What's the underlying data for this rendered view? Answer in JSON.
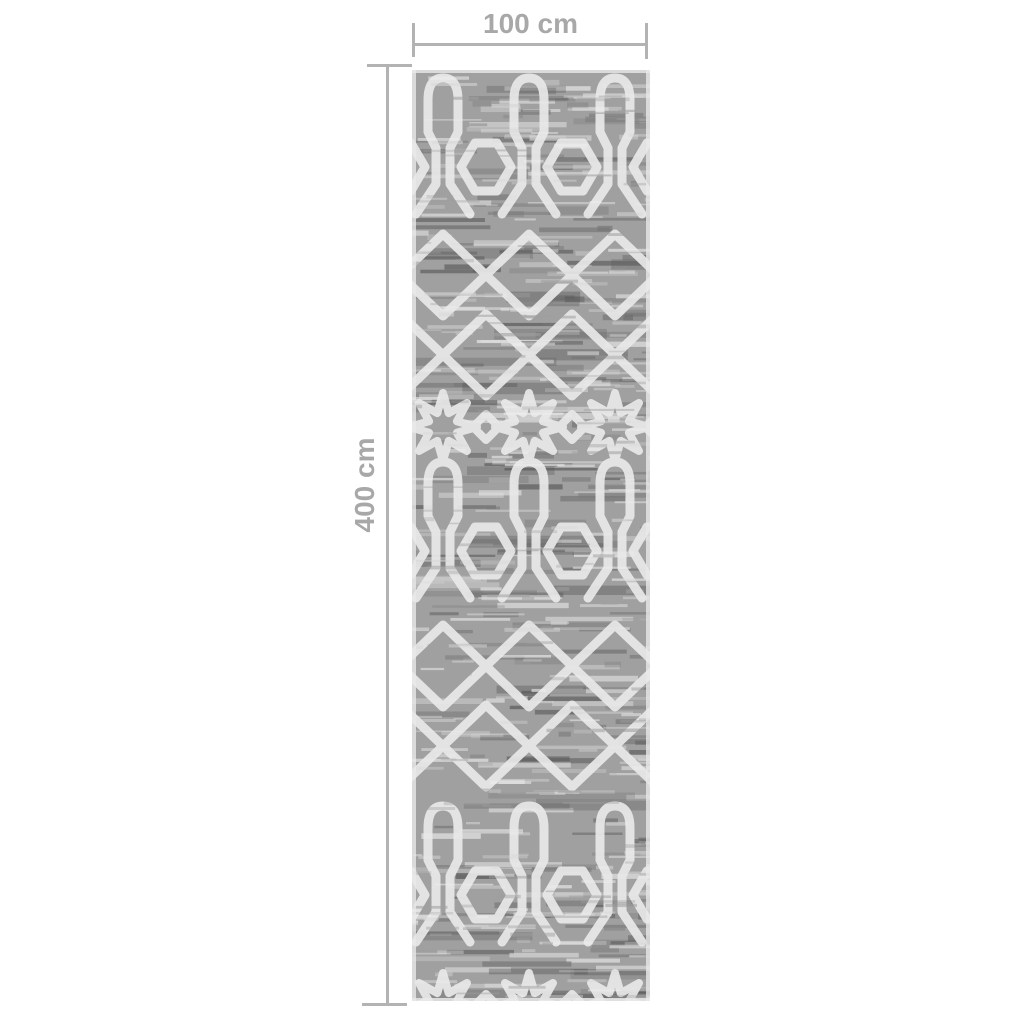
{
  "annotations": {
    "width": {
      "label": "100 cm"
    },
    "height": {
      "label": "400 cm"
    }
  },
  "colors": {
    "background": "#ffffff",
    "annotation": "#b3b3b3",
    "annotation_text": "#a8a8a8",
    "rug_base": "#a0a0a0",
    "rug_pattern": "#e9e9e9",
    "rug_dark": "#5e5e5e",
    "rug_light": "#d8d8d8"
  }
}
